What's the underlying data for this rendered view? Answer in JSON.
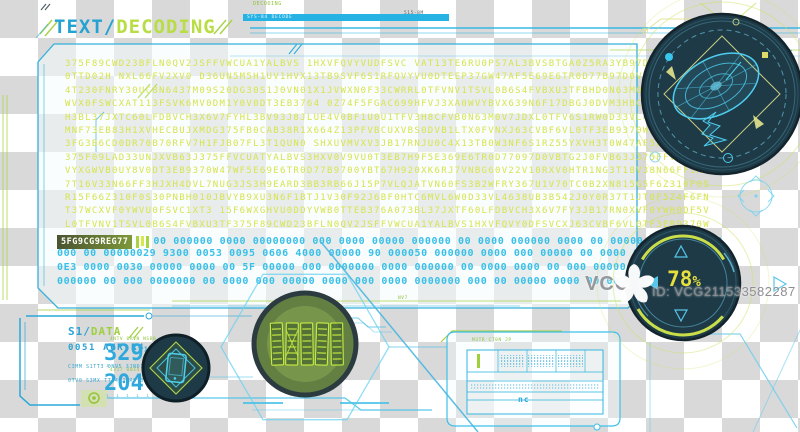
{
  "title": {
    "prefix": "TEXT/",
    "word": "DECODING"
  },
  "topbar": {
    "tag": "DECODING",
    "code": "515-8M",
    "bar_label": "SYS-84 DECODE"
  },
  "decode": {
    "rows": [
      "375F89CWD23BFLN0QV2JSFFVWCUA1YALBVS 1HXVFQVYVUDFSVC VAT13TE6RU0PS7AL3BVSBTGA0Z5RA3YB97D0VBTG2J0F",
      "0TTD02H NXL66FV2XV0 D36UN5M5H1UV1HVX13TB9SVF6S1RFQVYVU0DTEEP37GW47AF5E69E6TR0D77B97D0V8T67H920XK",
      "4T230FNRY30UC8N6437M09S20DG30S1J0VN01X1JVWXN0F33CWRRL0TFVNV1TSVL0B6S4FVBXU3TFBHD0N63M0V7JDXL0TFV",
      "WVX0FSWCXAT113FSVK6MV0DM1Y0V0DT3EB3764 0Z74F5FGAC699HFVJ3XA0WVYBVX639N6F17DBGJ0DVM3H8CFVB0N63M0V",
      "H3BL37JXTC60LFDBVCH3X6V7FYHL3BV93J8JLUE4V0BF1U0U1TFV3H8CFVB0N63M0V7JDXL0TFV6S1RW0D33VL4638UB3B54",
      "MNF73EB83H1XVHECBUJXMDG375FB0CAB38R1X664Z13PFVBCUXVBS0DVB1LTX0FVNXJ63CVBF6VL0TF3EB9370W47WF5E69E",
      "3FG3B6CD0DR70B70RFV7H1FJB07FL3T1QUN0 SHXUVMVXV3JB17RNJU0C4X13TB0W3NF6S1RZ55YXVH3T0W47AF5E69E6TR0",
      "375F09LAD33UNJXVB63J375FFVCUATYALBVS3HXV0V9VU0T3EB7H9F5E369E6TR0D77097D0VBTG2J0FVB63J375FFVCUATY",
      "VYXGWVB0UY8V0DT3EB9370W47WF5E69E6TR0D77B9700YBT67H920XK6RJ7VNBG60V22V10RXV0HTR1NG3T18V38N66FF3HJ",
      "7T16V33N66FF3HJXH4DVL7NUG3JS3H9EARD3BB3RB66J15P7VLQJATVN60FS3B2WFRY367U1V70TC0B2XN815G5F6Z310F05",
      "R15F66Z310F0S30PNBH010JBVYB9XU3N6F1BTJ1V30F92J6BF0HTC6MVL6W0D33VL4638UB3B542J0Y0R37T1JT0F5Z4F6FN",
      "T37WCXVF0YWVU0FSVC1XT3 15F6WXGHVU0DDYVWB0TTEB376A073BL37JXTF60LFDBVCH3X6V7FY3JB17RN0XVF0YWH0DF5V",
      "L0TFVNV1TSVL0B6S4FVBXU3TF375F89CWD23BFLN0QV2JSFFVWCUA1YALBVS1HXVFQVY0DFSVCXJ63CVBF6VL0TF3EB9370W"
    ]
  },
  "chip": {
    "label": "5FG9CG9REG77"
  },
  "digital": {
    "inline": "00 000000 0000 00000000 000 0000 00000 000000 00 0000 000000 0000 00 00000 000 0000 00",
    "rows": [
      "000 00 00000029 9300 0053 0095 0606 4000 00000 90 000050 000000 0000 000 00000 00 0000 0000 000 00",
      "0E3 0000 0030 00000 0000 00 5F 00000 000 0000000 0000 000000 00 0000 0000 00 000 00000 000 0000 00",
      "000000 00 000 0000000 00 0000 000 00000 0000 000 0000 0000000 000 00 00000 0000 00 0000 000 000 00"
    ]
  },
  "gauge": {
    "value": "78",
    "unit": "%"
  },
  "watermark": {
    "brand": "VCG",
    "id": "ID: VCG211533582287"
  },
  "data_panel": {
    "prefix": "S1/",
    "word": "DATA",
    "code": "0051 AGR R4",
    "micro1": "C3MM S1TT3 0NV5 3JND1TZ 0RV",
    "micro2": "0TV0 S3MX TT34 JPRS 0N6 V1N",
    "metric1": {
      "label": "4NTV 0RVN NSB0",
      "value": "329",
      "sup": "15",
      "ticks": "ı ı ı ı ı ı ı ı ı"
    },
    "metric2": {
      "label": "4317 00Z4 7VN0",
      "value": "204",
      "sup": "16",
      "ticks": "ı ı ı ı ı ı ı ı"
    }
  },
  "table": {
    "label": "M3TR CT0N 2P",
    "note": "nc"
  },
  "micro": {
    "circuit": "NV7"
  },
  "colors": {
    "accent_blue": "#29a9d8",
    "accent_green": "#b5dd4a",
    "cyan": "#3cc2e8",
    "yellow_text": "#d7e44c",
    "gauge_yellow": "#e6df3d",
    "dark_circle": "#1d3a46"
  }
}
